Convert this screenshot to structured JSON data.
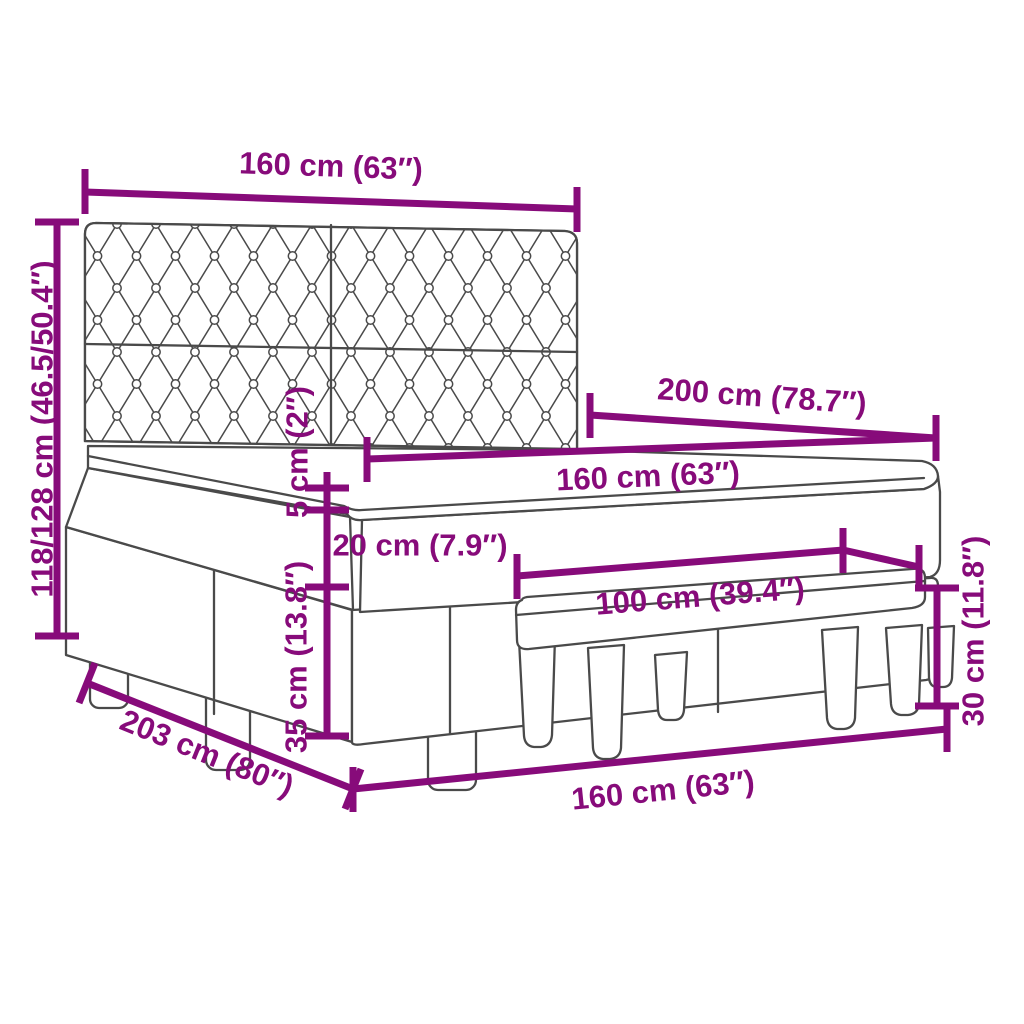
{
  "colors": {
    "dimension_accent": "#870b7a",
    "drawing_line": "#4a4a4a",
    "background": "#ffffff"
  },
  "dim_labels": {
    "headboard_width": "160 cm (63″)",
    "total_height": "118/128 cm (46.5/50.4″)",
    "bed_length": "200 cm (78.7″)",
    "mattress_width": "160 cm (63″)",
    "topper_thickness": "5 cm (2″)",
    "mattress_thickness": "20 cm (7.9″)",
    "base_height": "35 cm (13.8″)",
    "bench_length": "100 cm (39.4″)",
    "bench_height": "30 cm (11.8″)",
    "bed_total_length": "203 cm (80″)",
    "bed_width": "160 cm (63″)"
  }
}
